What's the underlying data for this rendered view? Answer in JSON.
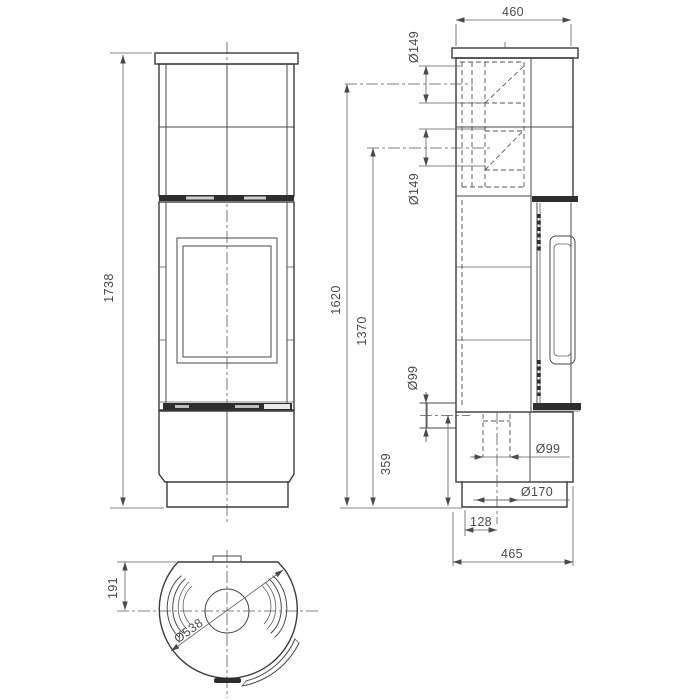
{
  "drawing_colors": {
    "background": "#ffffff",
    "line": "#3c3c3c",
    "dimension_text": "#4a4a4a"
  },
  "dims": {
    "front_overall_height": "1738",
    "side_top_width": "460",
    "side_height_top_flue": "1620",
    "side_height_rear_flue": "1370",
    "side_height_rear_air": "359",
    "side_dia_top_flue": "Ø149",
    "side_dia_rear_flue": "Ø149",
    "side_dia_rear_air": "Ø99",
    "side_dia_bottom_air": "Ø99",
    "side_dia_floor_opening": "Ø170",
    "side_offset_bottom_air": "128",
    "side_base_width": "465",
    "top_dia_body": "Ø538",
    "top_rear_flat": "191"
  }
}
